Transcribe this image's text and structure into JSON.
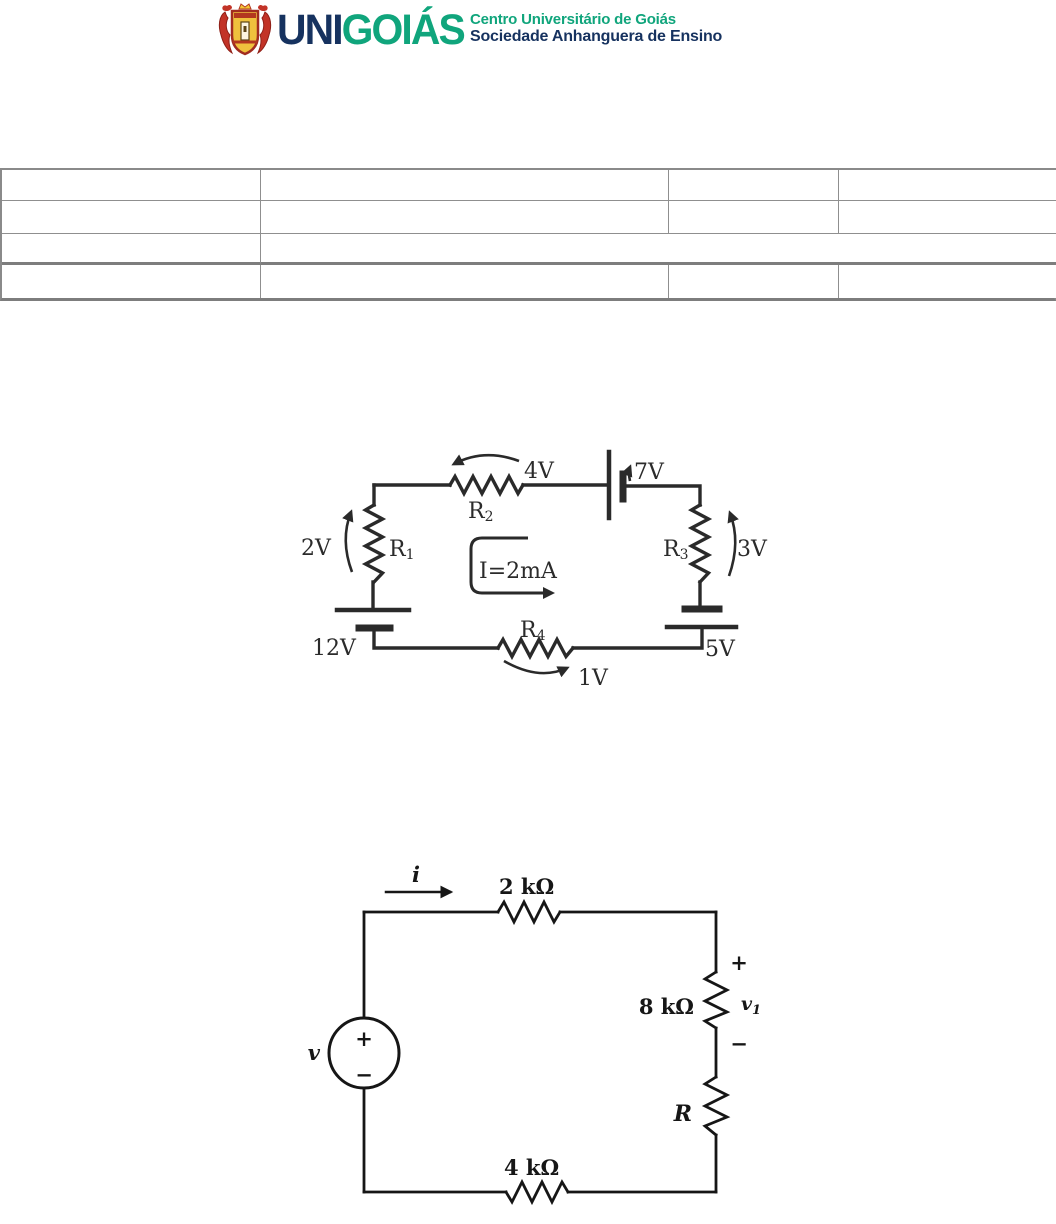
{
  "header": {
    "brand_uni": "UNI",
    "brand_goias": "GOIÁS",
    "org_line1": "Centro Universitário de Goiás",
    "org_line2": "Sociedade Anhanguera de Ensino",
    "colors": {
      "green": "#10A57C",
      "navy": "#16325F"
    }
  },
  "identification_table": {
    "rows": [
      [
        "",
        "",
        "",
        ""
      ],
      [
        "",
        "",
        "",
        ""
      ],
      [
        "",
        ""
      ],
      [
        "",
        "",
        "",
        ""
      ]
    ]
  },
  "circuit1": {
    "labels": {
      "v_r1": "2V",
      "v_r2": "4V",
      "v_bat_top": "7V",
      "v_r3": "3V",
      "v_bat_left": "12V",
      "v_r4": "1V",
      "v_bat_right": "5V",
      "loop_current": "I=2mA"
    },
    "resistors": {
      "r1": {
        "base": "R",
        "sub": "1"
      },
      "r2": {
        "base": "R",
        "sub": "2"
      },
      "r3": {
        "base": "R",
        "sub": "3"
      },
      "r4": {
        "base": "R",
        "sub": "4"
      }
    }
  },
  "circuit2": {
    "labels": {
      "current": "i",
      "source": "v",
      "source_plus": "+",
      "source_minus": "−",
      "r_top": "2 kΩ",
      "r_right": "8 kΩ",
      "r_bottom": "4 kΩ",
      "r_unknown": "R",
      "v1_base": "v",
      "v1_sub": "1",
      "v1_plus": "+",
      "v1_minus": "−"
    }
  }
}
